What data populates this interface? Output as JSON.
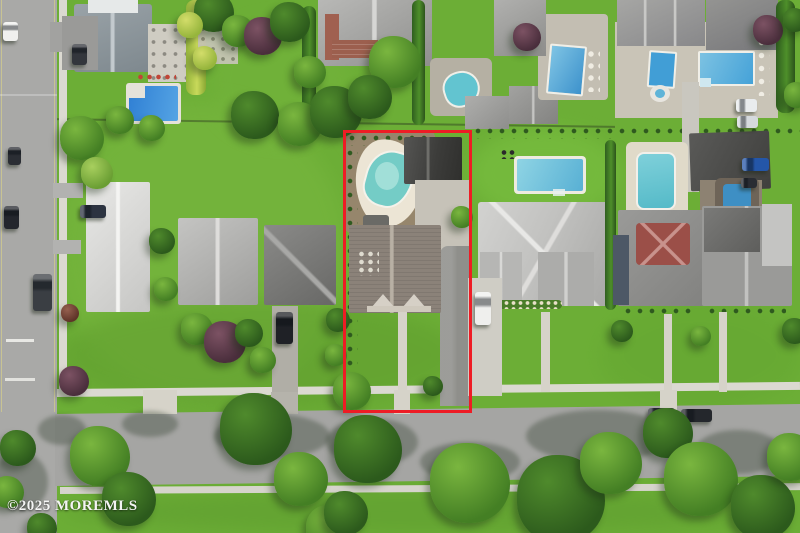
{
  "watermark": {
    "text": "©2025 MOREMLS"
  },
  "highlight": {
    "name": "property-boundary",
    "color": "#ee1c25"
  },
  "palette": {
    "lawn": "#6cae36",
    "lawn_light": "#7ab840",
    "road": "#a8a8a6",
    "sidewalk": "#dbd9d1",
    "concrete": "#cfcdc5",
    "pool_water_kidney": "#74ccc6",
    "pool_water_blue": "#3f97d3",
    "pool_deck": "#ece5d5",
    "mulch": "#96866c",
    "roof_light": "#c9c8c6",
    "roof_mid": "#8b8279",
    "roof_dark": "#3c3c3c",
    "roof_maroon": "#9b4f48",
    "tree_dark": "#2f5e1f",
    "tree_mid": "#4e8f2a",
    "tree_light": "#79b33c",
    "tree_purple": "#5a3744",
    "curb_stripe": "#cfc98f"
  },
  "scene": {
    "type": "aerial-photograph",
    "summary": "Drone view of a suburban block; red boundary outlines one lot containing a kidney-shaped pool, dark detached garage, gray-roof house and long side driveway; neighboring homes have pools; streets run along the left and bottom.",
    "trees": [
      [
        214,
        12,
        20,
        "dark"
      ],
      [
        238,
        31,
        16,
        "mid"
      ],
      [
        263,
        36,
        19,
        "purple"
      ],
      [
        290,
        22,
        20,
        "dark"
      ],
      [
        310,
        72,
        16,
        "mid"
      ],
      [
        255,
        115,
        24,
        "dark"
      ],
      [
        300,
        124,
        22,
        "mid"
      ],
      [
        336,
        112,
        26,
        "dark"
      ],
      [
        395,
        62,
        26,
        "mid"
      ],
      [
        370,
        97,
        22,
        "dark"
      ],
      [
        120,
        120,
        14,
        "mid"
      ],
      [
        152,
        128,
        13,
        "mid"
      ],
      [
        82,
        138,
        22,
        "mid"
      ],
      [
        97,
        173,
        16,
        "light"
      ],
      [
        70,
        313,
        9,
        "red"
      ],
      [
        74,
        381,
        15,
        "purple"
      ],
      [
        18,
        448,
        18,
        "dark"
      ],
      [
        8,
        492,
        16,
        "mid"
      ],
      [
        42,
        528,
        15,
        "dark"
      ],
      [
        162,
        241,
        13,
        "dark"
      ],
      [
        166,
        289,
        12,
        "mid"
      ],
      [
        197,
        329,
        16,
        "mid"
      ],
      [
        225,
        342,
        21,
        "purple"
      ],
      [
        249,
        333,
        14,
        "dark"
      ],
      [
        263,
        360,
        13,
        "mid"
      ],
      [
        100,
        456,
        30,
        "mid"
      ],
      [
        129,
        499,
        27,
        "dark"
      ],
      [
        256,
        429,
        36,
        "dark"
      ],
      [
        301,
        479,
        27,
        "mid"
      ],
      [
        330,
        529,
        24,
        "mid"
      ],
      [
        346,
        513,
        22,
        "dark"
      ],
      [
        368,
        449,
        34,
        "dark"
      ],
      [
        352,
        391,
        19,
        "mid"
      ],
      [
        338,
        320,
        12,
        "dark"
      ],
      [
        336,
        355,
        11,
        "mid"
      ],
      [
        433,
        386,
        10,
        "dark"
      ],
      [
        462,
        217,
        11,
        "mid"
      ],
      [
        470,
        483,
        40,
        "mid"
      ],
      [
        561,
        499,
        44,
        "dark"
      ],
      [
        611,
        463,
        31,
        "mid"
      ],
      [
        668,
        433,
        25,
        "dark"
      ],
      [
        701,
        479,
        37,
        "mid"
      ],
      [
        763,
        507,
        32,
        "dark"
      ],
      [
        791,
        457,
        24,
        "mid"
      ],
      [
        622,
        331,
        11,
        "dark"
      ],
      [
        701,
        336,
        10,
        "mid"
      ],
      [
        795,
        331,
        13,
        "dark"
      ],
      [
        527,
        37,
        14,
        "purple"
      ],
      [
        768,
        30,
        15,
        "purple"
      ],
      [
        795,
        20,
        12,
        "dark"
      ],
      [
        797,
        95,
        13,
        "mid"
      ],
      [
        190,
        25,
        13,
        "yellow"
      ],
      [
        205,
        58,
        12,
        "yellow"
      ]
    ],
    "cars": [
      {
        "x": 3,
        "y": 22,
        "w": 15,
        "h": 19,
        "c": "#f0f0ee",
        "o": "v"
      },
      {
        "x": 8,
        "y": 147,
        "w": 13,
        "h": 18,
        "c": "#2b2e34",
        "o": "v"
      },
      {
        "x": 4,
        "y": 206,
        "w": 15,
        "h": 23,
        "c": "#23262c",
        "o": "v"
      },
      {
        "x": 33,
        "y": 274,
        "w": 19,
        "h": 37,
        "c": "#3a3e43",
        "o": "v"
      },
      {
        "x": 72,
        "y": 44,
        "w": 15,
        "h": 21,
        "c": "#33363c",
        "o": "v"
      },
      {
        "x": 80,
        "y": 205,
        "w": 26,
        "h": 13,
        "c": "#2c3340",
        "o": "h"
      },
      {
        "x": 276,
        "y": 312,
        "w": 17,
        "h": 32,
        "c": "#1f2126",
        "o": "v"
      },
      {
        "x": 232,
        "y": 410,
        "w": 30,
        "h": 14,
        "c": "#f2f2f0",
        "o": "h"
      },
      {
        "x": 475,
        "y": 292,
        "w": 16,
        "h": 33,
        "c": "#efefed",
        "o": "v"
      },
      {
        "x": 648,
        "y": 408,
        "w": 27,
        "h": 13,
        "c": "#34383e",
        "o": "h"
      },
      {
        "x": 681,
        "y": 409,
        "w": 31,
        "h": 13,
        "c": "#24272c",
        "o": "h"
      },
      {
        "x": 742,
        "y": 158,
        "w": 27,
        "h": 13,
        "c": "#2456a8",
        "o": "h"
      },
      {
        "x": 741,
        "y": 178,
        "w": 16,
        "h": 10,
        "c": "#2a2d33",
        "o": "h"
      },
      {
        "x": 736,
        "y": 99,
        "w": 21,
        "h": 13,
        "c": "#e9ecee",
        "o": "h"
      },
      {
        "x": 737,
        "y": 116,
        "w": 21,
        "h": 12,
        "c": "#d5d9dd",
        "o": "h"
      }
    ],
    "road_shadows": [
      [
        272,
        436,
        58,
        22
      ],
      [
        372,
        442,
        46,
        24
      ],
      [
        598,
        436,
        72,
        26
      ],
      [
        738,
        452,
        44,
        22
      ],
      [
        150,
        424,
        28,
        13
      ],
      [
        62,
        430,
        24,
        15
      ],
      [
        20,
        482,
        28,
        30
      ],
      [
        470,
        462,
        50,
        20
      ]
    ]
  }
}
